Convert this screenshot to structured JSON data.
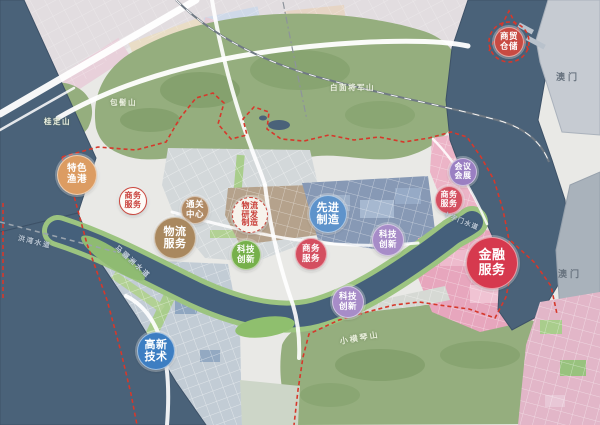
{
  "map": {
    "title": "功能分区规划图",
    "palette": {
      "water": "#4a6279",
      "mountain": "#95ae7e",
      "boundary_red": "#d6382b",
      "zone_blue": "#8799b5",
      "zone_pink": "#e7a6bd",
      "zone_tan": "#b5a28c"
    },
    "zone_badges": [
      {
        "name": "zone-badge-trade-warehousing",
        "lines": [
          "商贸",
          "仓储"
        ],
        "x": 509,
        "y": 42,
        "r": 15,
        "bg": "#c84a42",
        "color": "#ffffff",
        "font": 8.5,
        "border": "1px solid rgba(255,255,255,.5)"
      },
      {
        "name": "zone-badge-special-fishing-port",
        "lines": [
          "特色",
          "渔港"
        ],
        "x": 77,
        "y": 175,
        "r": 20,
        "bg": "#dc9c62",
        "color": "#ffffff",
        "font": 9.5,
        "border": "1px solid rgba(255,255,255,.5)"
      },
      {
        "name": "zone-badge-business-services-west",
        "lines": [
          "商务",
          "服务"
        ],
        "x": 133,
        "y": 201,
        "r": 14,
        "bg": "#fdfbf7",
        "color": "#c9403a",
        "font": 8,
        "border": "1.5px solid #cc463d"
      },
      {
        "name": "zone-badge-customs-center",
        "lines": [
          "通关",
          "中心"
        ],
        "x": 195,
        "y": 210,
        "r": 14,
        "bg": "#b08a64",
        "color": "#ffffff",
        "font": 8.5,
        "border": "1px solid rgba(255,255,255,.5)"
      },
      {
        "name": "zone-badge-logistics-rd-manufacturing",
        "lines": [
          "物流",
          "研发",
          "制造"
        ],
        "x": 250,
        "y": 215,
        "r": 18,
        "bg": "#f7f3ec",
        "color": "#c9403a",
        "font": 8,
        "border": "1.5px dashed #cc463d"
      },
      {
        "name": "zone-badge-logistics-services",
        "lines": [
          "物流",
          "服务"
        ],
        "x": 175,
        "y": 238,
        "r": 21,
        "bg": "#a9885f",
        "color": "#ffffff",
        "font": 11,
        "border": "1px solid rgba(255,255,255,.5)"
      },
      {
        "name": "zone-badge-advanced-manufacturing",
        "lines": [
          "先进",
          "制造"
        ],
        "x": 328,
        "y": 214,
        "r": 19,
        "bg": "#5e93cb",
        "color": "#ffffff",
        "font": 11,
        "border": "1px solid rgba(255,255,255,.5)"
      },
      {
        "name": "zone-badge-tech-innovation-green",
        "lines": [
          "科技",
          "创新"
        ],
        "x": 246,
        "y": 255,
        "r": 15,
        "bg": "#76b04b",
        "color": "#ffffff",
        "font": 8.5,
        "border": "1px solid rgba(255,255,255,.5)"
      },
      {
        "name": "zone-badge-business-services-center",
        "lines": [
          "商务",
          "服务"
        ],
        "x": 311,
        "y": 254,
        "r": 16,
        "bg": "#d44f60",
        "color": "#ffffff",
        "font": 8.5,
        "border": "1px solid rgba(255,255,255,.5)"
      },
      {
        "name": "zone-badge-tech-innovation-north",
        "lines": [
          "科技",
          "创新"
        ],
        "x": 388,
        "y": 240,
        "r": 16,
        "bg": "#a78cc8",
        "color": "#ffffff",
        "font": 8.5,
        "border": "1px solid rgba(255,255,255,.5)"
      },
      {
        "name": "zone-badge-conference-exhibition",
        "lines": [
          "会议",
          "会展"
        ],
        "x": 463,
        "y": 172,
        "r": 14,
        "bg": "#9a7fc2",
        "color": "#ffffff",
        "font": 8,
        "border": "1px solid rgba(255,255,255,.5)"
      },
      {
        "name": "zone-badge-business-services-east",
        "lines": [
          "商务",
          "服务"
        ],
        "x": 449,
        "y": 200,
        "r": 14,
        "bg": "#d44f60",
        "color": "#ffffff",
        "font": 8,
        "border": "1px solid rgba(255,255,255,.5)"
      },
      {
        "name": "zone-badge-financial-services",
        "lines": [
          "金融",
          "服务"
        ],
        "x": 492,
        "y": 263,
        "r": 26,
        "bg": "#d6394e",
        "color": "#ffffff",
        "font": 13,
        "border": "1px solid rgba(255,255,255,.5)"
      },
      {
        "name": "zone-badge-tech-innovation-south",
        "lines": [
          "科技",
          "创新"
        ],
        "x": 348,
        "y": 302,
        "r": 16,
        "bg": "#a78cc8",
        "color": "#ffffff",
        "font": 8.5,
        "border": "1px solid rgba(255,255,255,.5)"
      },
      {
        "name": "zone-badge-hightech",
        "lines": [
          "高新",
          "技术"
        ],
        "x": 156,
        "y": 351,
        "r": 19,
        "bg": "#3d7ec2",
        "color": "#ffffff",
        "font": 11,
        "border": "1px solid rgba(255,255,255,.5)"
      }
    ],
    "labels": [
      {
        "name": "mountain-label-guiding-shan",
        "kind": "mountain",
        "text": "桂定山",
        "x": 44,
        "y": 116,
        "size": 7.5,
        "color": "#edf2e2",
        "spacing": 1.5,
        "rotate": 0
      },
      {
        "name": "mountain-label-baoji-shan",
        "kind": "mountain",
        "text": "包髻山",
        "x": 110,
        "y": 97,
        "size": 7.5,
        "color": "#edf2e2",
        "spacing": 1.5,
        "rotate": 0
      },
      {
        "name": "mountain-label-baimian-jiangjun-shan",
        "kind": "mountain",
        "text": "白面将军山",
        "x": 330,
        "y": 82,
        "size": 7.5,
        "color": "#edf2e2",
        "spacing": 1.5,
        "rotate": 0
      },
      {
        "name": "mountain-label-xiaohengqin-shan",
        "kind": "mountain",
        "text": "小横琴山",
        "x": 340,
        "y": 336,
        "size": 8,
        "color": "#e9efdc",
        "spacing": 2,
        "rotate": -10
      },
      {
        "name": "water-label-maliuzhou-waterway",
        "kind": "water",
        "text": "马骝洲水道",
        "x": 116,
        "y": 242,
        "size": 7,
        "color": "#c6d1dd",
        "spacing": 2,
        "rotate": 42
      },
      {
        "name": "water-label-hongwan-waterway",
        "kind": "water",
        "text": "洪湾水道",
        "x": 18,
        "y": 233,
        "size": 7,
        "color": "#b9c5d2",
        "spacing": 1.5,
        "rotate": 14
      },
      {
        "name": "water-label-shizimen-waterway",
        "kind": "water",
        "text": "十字门水道",
        "x": 444,
        "y": 208,
        "size": 6.5,
        "color": "#bcc8d5",
        "spacing": 1,
        "rotate": 22
      },
      {
        "name": "place-label-macau-north",
        "kind": "place",
        "text": "澳门",
        "x": 556,
        "y": 70,
        "size": 9,
        "color": "#68737f",
        "spacing": 3,
        "rotate": 0
      },
      {
        "name": "place-label-macau-east",
        "kind": "place",
        "text": "澳门",
        "x": 558,
        "y": 267,
        "size": 9,
        "color": "#68737f",
        "spacing": 3,
        "rotate": 0
      }
    ]
  }
}
